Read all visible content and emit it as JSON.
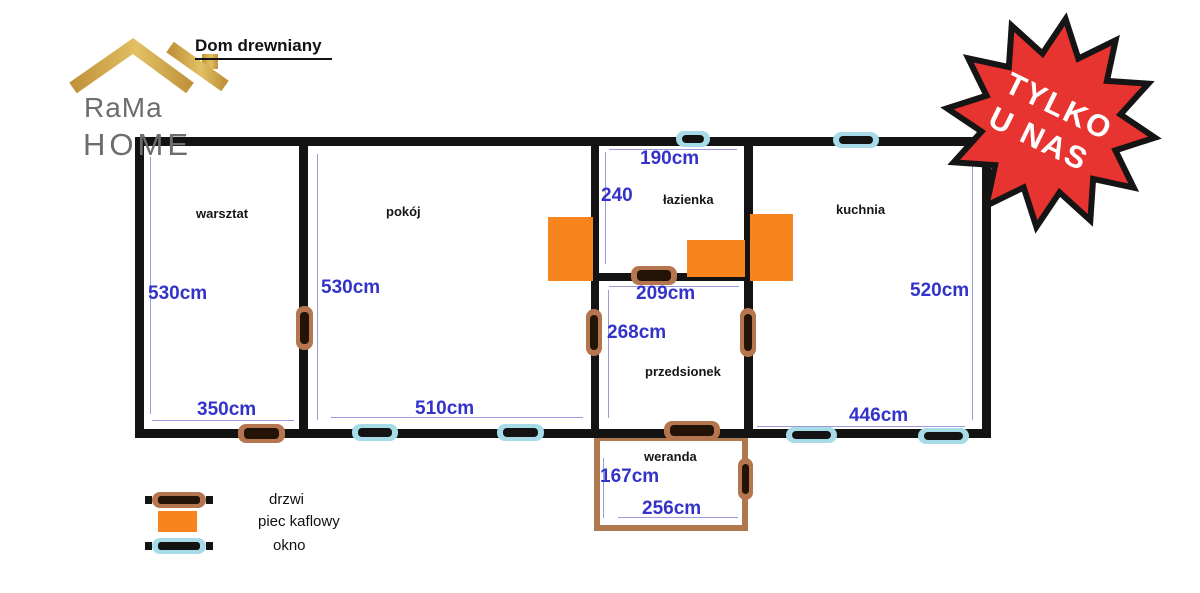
{
  "title": "Dom drewniany",
  "logo": {
    "line1": "RaMa",
    "line2": "HOME"
  },
  "badge": {
    "line1": "TYLKO",
    "line2": "U NAS"
  },
  "rooms": {
    "warsztat": {
      "name": "warsztat",
      "height": "530cm",
      "width": "350cm"
    },
    "pokoj": {
      "name": "pokój",
      "height": "530cm",
      "width": "510cm"
    },
    "lazienka": {
      "name": "łazienka",
      "width": "190cm",
      "height": "240"
    },
    "kuchnia": {
      "name": "kuchnia",
      "height": "520cm",
      "width": "446cm"
    },
    "przedsionek": {
      "name": "przedsionek",
      "width": "209cm",
      "height": "268cm"
    },
    "weranda": {
      "name": "weranda",
      "height": "167cm",
      "width": "256cm"
    }
  },
  "legend": {
    "items": [
      {
        "icon": "door-icon",
        "label": "drzwi"
      },
      {
        "icon": "stove-icon",
        "label": "piec kaflowy"
      },
      {
        "icon": "window-icon",
        "label": "okno"
      }
    ]
  },
  "colors": {
    "wall": "#131313",
    "door": "#b5754e",
    "doorBar": "#241307",
    "window": "#a6dbe7",
    "stove": "#f8841d",
    "dim": "#3333c9",
    "dimLine": "#9a9ada",
    "star": "#e73430",
    "starStroke": "#151515",
    "gold1": "#c0923a",
    "gold2": "#e2c063",
    "logoText": "#6d6d6d",
    "weranda": "#b0784f"
  }
}
